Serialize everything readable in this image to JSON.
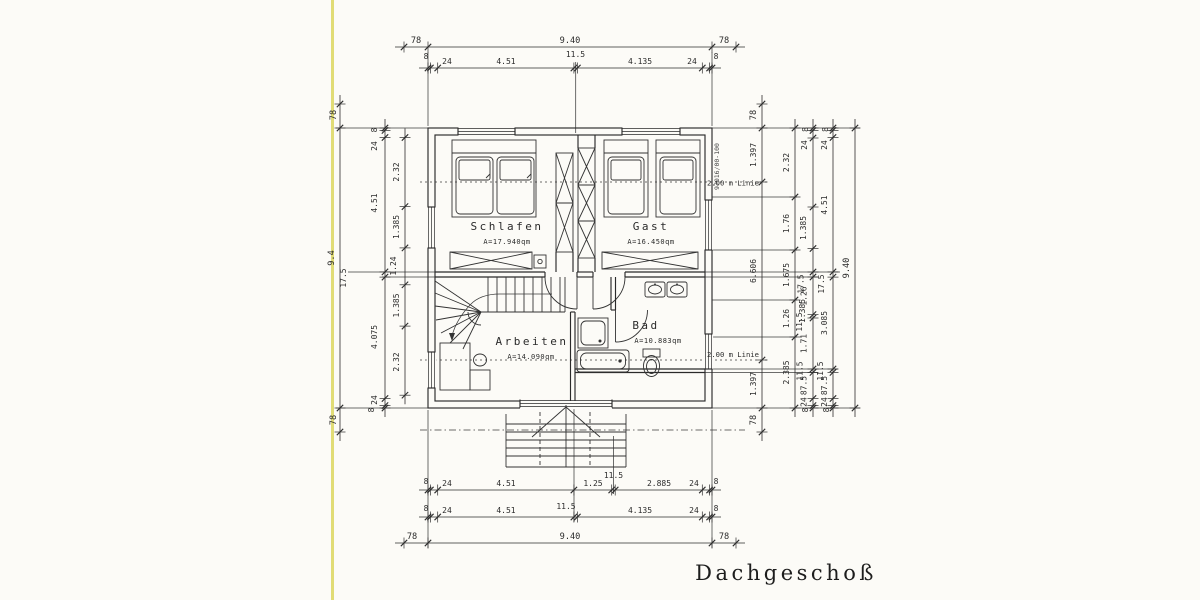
{
  "title": "Dachgeschoß",
  "drawing_number": "97016/00-100",
  "rooms": {
    "schlafen": {
      "name": "Schlafen",
      "area": "A=17.940qm"
    },
    "gast": {
      "name": "Gast",
      "area": "A=16.450qm"
    },
    "arbeiten": {
      "name": "Arbeiten",
      "area": "A=14.090qm"
    },
    "bad": {
      "name": "Bad",
      "area": "A=10.883qm"
    }
  },
  "lines": {
    "linie_top": "2.00 m Linie",
    "linie_bottom": "2.00 m Linie"
  },
  "dims": {
    "top_total": [
      "78",
      "9.40",
      "78"
    ],
    "top_detail": [
      "8",
      "24",
      "4.51",
      "11.5",
      "4.135",
      "24",
      "8"
    ],
    "bottom_row1": [
      "8",
      "24",
      "4.51",
      "1.25",
      "11.5",
      "2.885",
      "24",
      "8"
    ],
    "bottom_row2": [
      "8",
      "24",
      "4.51",
      "11.5",
      "4.135",
      "24",
      "8"
    ],
    "bottom_total": [
      "78",
      "9.40",
      "78"
    ],
    "left_total": [
      "78",
      "9.4",
      "78"
    ],
    "left_detail": [
      "8",
      "24",
      "4.51",
      "17.5",
      "4.075",
      "24",
      "8"
    ],
    "left_inner": [
      "2.32",
      "1.385",
      "1.24",
      "1.385",
      "2.32"
    ],
    "right_knee": [
      "78",
      "1.397",
      "6.606",
      "1.397",
      "78"
    ],
    "right_inner": [
      "2.32",
      "1.76",
      "1.675",
      "1.26",
      "2.385"
    ],
    "right_mid": [
      "8",
      "24",
      "1.385",
      "17.5",
      "1.26",
      "1.385",
      "11.5",
      "1.71",
      "11.5",
      "87.5",
      "24",
      "8"
    ],
    "right_detail": [
      "8",
      "24",
      "4.51",
      "17.5",
      "3.085",
      "11.5",
      "87.5",
      "24",
      "8"
    ],
    "right_total": "9.40"
  }
}
